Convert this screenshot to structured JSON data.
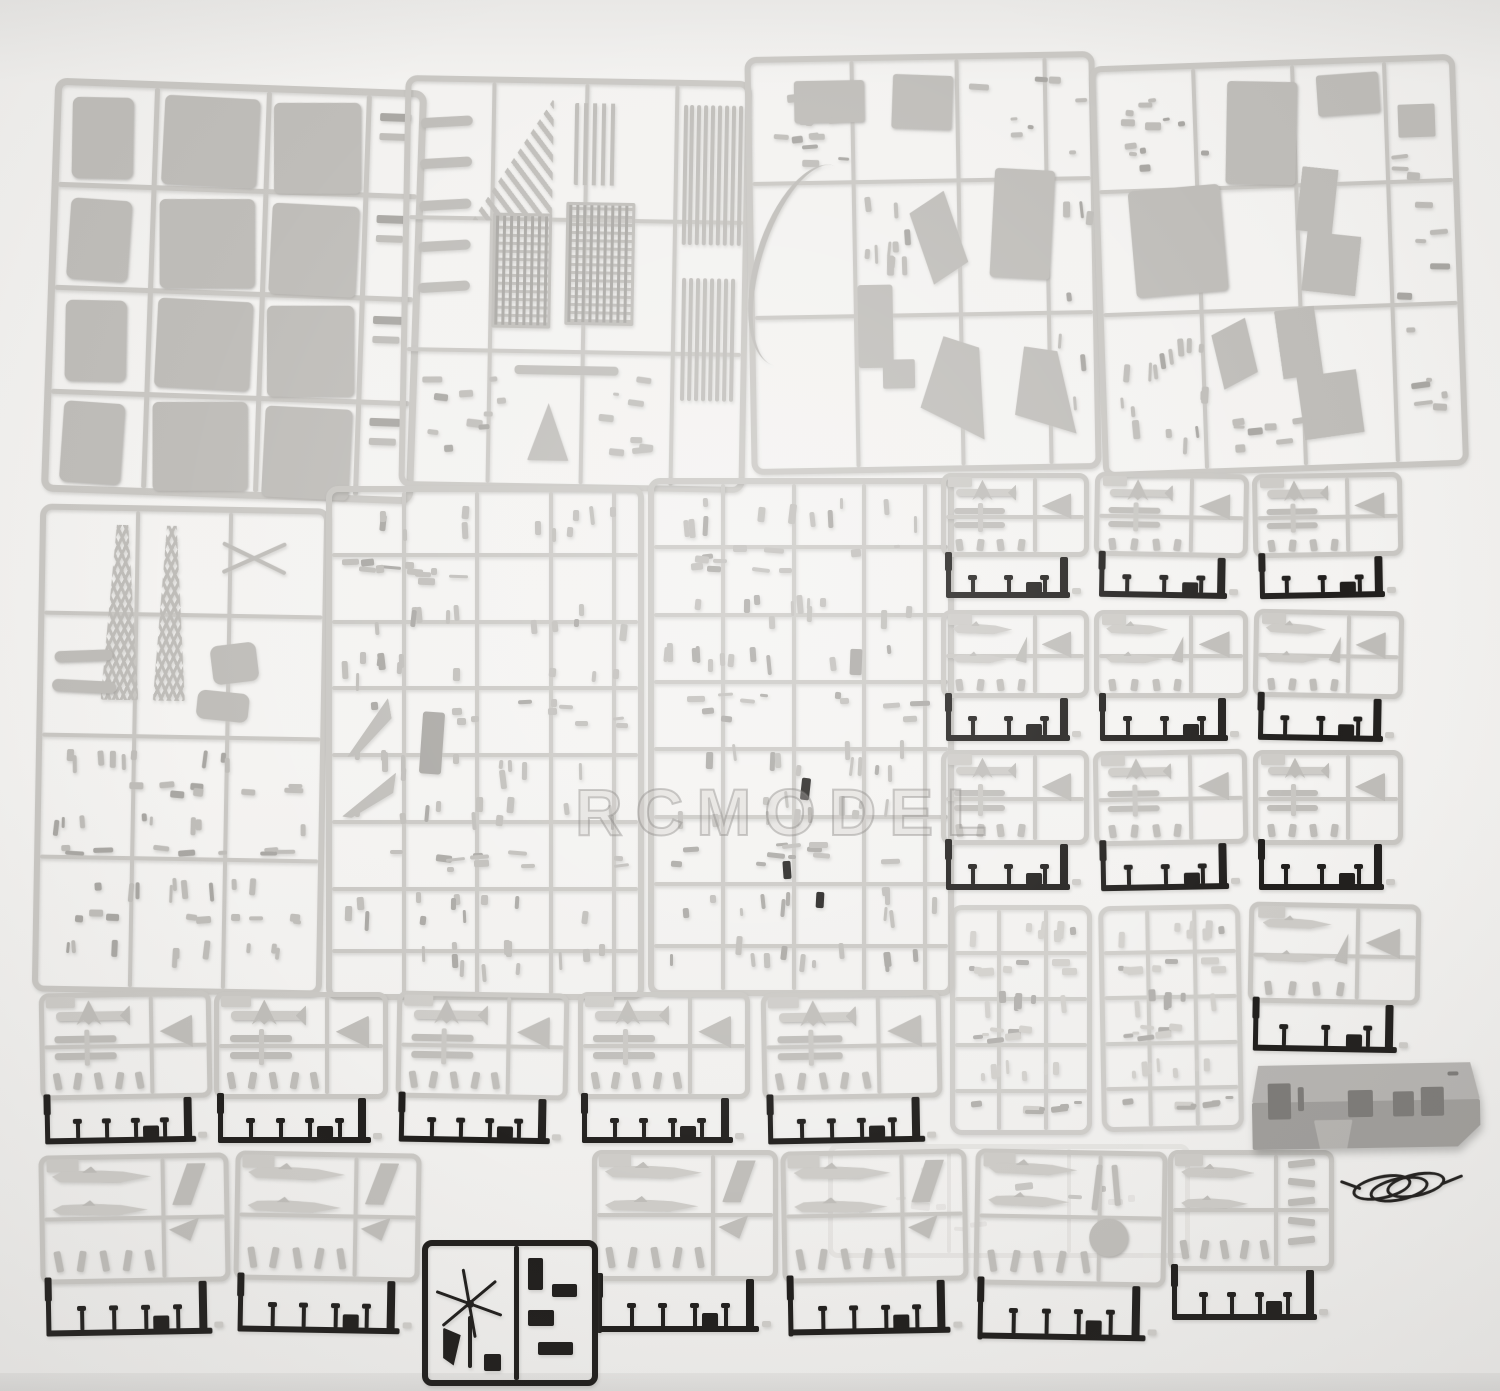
{
  "photo": {
    "width": 1500,
    "height": 1391,
    "background": "#f3f2f0",
    "subject": "plastic-model-kit-sprues-on-white-table"
  },
  "watermark": {
    "text": "RCMODEL"
  },
  "colors": {
    "runner": "#c9c7c3",
    "runnerDark": "#b3b1ae",
    "part": "#bfbdb9",
    "partLight": "#cdcbc7",
    "partDark": "#a9a7a3",
    "black": "#211f1d",
    "ghost": "#dcdad7",
    "boxTop": "#b6b4b1",
    "boxFront": "#a09e9b",
    "boxHole": "#7d7b78",
    "shadow": "rgba(110,108,105,0.28)"
  },
  "sprues": [
    {
      "name": "deck-panel-sprue",
      "kind": "panels",
      "x": 48,
      "y": 84,
      "w": 372,
      "h": 414,
      "rot": 2
    },
    {
      "name": "grating-sprue",
      "kind": "gratings",
      "x": 402,
      "y": 78,
      "w": 346,
      "h": 412,
      "rot": 1
    },
    {
      "name": "island-parts-sprue",
      "kind": "island",
      "x": 748,
      "y": 54,
      "w": 350,
      "h": 418,
      "rot": -1
    },
    {
      "name": "superstructure-block-sprue",
      "kind": "blocks",
      "x": 1096,
      "y": 60,
      "w": 366,
      "h": 412,
      "rot": -2
    },
    {
      "name": "fittings-sprue",
      "kind": "tinytall",
      "x": 36,
      "y": 506,
      "w": 290,
      "h": 488,
      "rot": 1
    },
    {
      "name": "detail-sprue-left",
      "kind": "dense",
      "x": 326,
      "y": 486,
      "w": 318,
      "h": 514,
      "rot": 0,
      "variant": 1
    },
    {
      "name": "detail-sprue-right",
      "kind": "dense",
      "x": 648,
      "y": 478,
      "w": 306,
      "h": 518,
      "rot": 0,
      "variant": 2
    },
    {
      "name": "aircraft-sprue-grid-1",
      "kind": "aircraft-cell",
      "x": 941,
      "y": 473,
      "w": 148,
      "h": 132,
      "rot": 0,
      "variant": 1
    },
    {
      "name": "aircraft-sprue-grid-2",
      "kind": "aircraft-cell",
      "x": 1094,
      "y": 473,
      "w": 154,
      "h": 132,
      "rot": 1,
      "variant": 1
    },
    {
      "name": "aircraft-sprue-grid-3",
      "kind": "aircraft-cell",
      "x": 1253,
      "y": 473,
      "w": 150,
      "h": 132,
      "rot": -1,
      "variant": 1
    },
    {
      "name": "aircraft-sprue-grid-4",
      "kind": "aircraft-cell",
      "x": 941,
      "y": 610,
      "w": 148,
      "h": 138,
      "rot": 0,
      "variant": 2
    },
    {
      "name": "aircraft-sprue-grid-5",
      "kind": "aircraft-cell",
      "x": 1094,
      "y": 610,
      "w": 154,
      "h": 138,
      "rot": 0,
      "variant": 2
    },
    {
      "name": "aircraft-sprue-grid-6",
      "kind": "aircraft-cell",
      "x": 1253,
      "y": 610,
      "w": 150,
      "h": 138,
      "rot": 1,
      "variant": 2
    },
    {
      "name": "aircraft-sprue-grid-7",
      "kind": "aircraft-cell",
      "x": 941,
      "y": 750,
      "w": 148,
      "h": 148,
      "rot": 0,
      "variant": 1
    },
    {
      "name": "aircraft-sprue-grid-8",
      "kind": "aircraft-cell",
      "x": 1094,
      "y": 750,
      "w": 154,
      "h": 148,
      "rot": -1,
      "variant": 1
    },
    {
      "name": "aircraft-sprue-grid-9",
      "kind": "aircraft-cell",
      "x": 1253,
      "y": 750,
      "w": 150,
      "h": 148,
      "rot": 0,
      "variant": 1
    },
    {
      "name": "weapons-sprue-1",
      "kind": "faintdense",
      "x": 950,
      "y": 905,
      "w": 142,
      "h": 230,
      "rot": 0
    },
    {
      "name": "weapons-sprue-2",
      "kind": "faintdense",
      "x": 1100,
      "y": 905,
      "w": 142,
      "h": 226,
      "rot": -1
    },
    {
      "name": "aircraft-sprue-right-column",
      "kind": "aircraft-cell",
      "x": 1248,
      "y": 903,
      "w": 172,
      "h": 158,
      "rot": 1,
      "variant": 2
    },
    {
      "name": "aircraft-sprue-row1-1",
      "kind": "aircraft-row",
      "x": 40,
      "y": 992,
      "w": 172,
      "h": 158,
      "rot": -1,
      "variant": 1
    },
    {
      "name": "aircraft-sprue-row1-2",
      "kind": "aircraft-row",
      "x": 214,
      "y": 992,
      "w": 174,
      "h": 158,
      "rot": 0,
      "variant": 1
    },
    {
      "name": "aircraft-sprue-row1-3",
      "kind": "aircraft-row",
      "x": 396,
      "y": 992,
      "w": 172,
      "h": 158,
      "rot": 1,
      "variant": 1
    },
    {
      "name": "aircraft-sprue-row1-4",
      "kind": "aircraft-row",
      "x": 578,
      "y": 992,
      "w": 172,
      "h": 158,
      "rot": 0,
      "variant": 1
    },
    {
      "name": "aircraft-sprue-row1-5",
      "kind": "aircraft-row",
      "x": 762,
      "y": 992,
      "w": 180,
      "h": 158,
      "rot": -1,
      "variant": 1
    },
    {
      "name": "clear-parts-ghost-sprue",
      "kind": "ghost",
      "x": 828,
      "y": 1144,
      "w": 362,
      "h": 114,
      "rot": 0
    },
    {
      "name": "aircraft-sprue-row2-1",
      "kind": "aircraft-row",
      "x": 40,
      "y": 1154,
      "w": 190,
      "h": 190,
      "rot": -1,
      "variant": 2
    },
    {
      "name": "aircraft-sprue-row2-2",
      "kind": "aircraft-row",
      "x": 234,
      "y": 1152,
      "w": 186,
      "h": 190,
      "rot": 1,
      "variant": 2
    },
    {
      "name": "aircraft-sprue-row2-3",
      "kind": "aircraft-row",
      "x": 592,
      "y": 1150,
      "w": 186,
      "h": 192,
      "rot": 0,
      "variant": 2
    },
    {
      "name": "aircraft-sprue-row2-4",
      "kind": "aircraft-row",
      "x": 782,
      "y": 1150,
      "w": 186,
      "h": 194,
      "rot": -1,
      "variant": 2
    },
    {
      "name": "aircraft-sprue-row2-5",
      "kind": "aircraft-row",
      "x": 974,
      "y": 1150,
      "w": 192,
      "h": 200,
      "rot": 1,
      "variant": 3
    },
    {
      "name": "aircraft-sprue-row2-6",
      "kind": "aircraft-row",
      "x": 1168,
      "y": 1150,
      "w": 166,
      "h": 178,
      "rot": 0,
      "variant": 4
    },
    {
      "name": "helicopter-rotor-black-sprue",
      "kind": "heli-black",
      "x": 422,
      "y": 1240,
      "w": 176,
      "h": 146,
      "rot": 0
    },
    {
      "name": "hull-box-part",
      "kind": "hull-box",
      "x": 1252,
      "y": 1064,
      "w": 228,
      "h": 84,
      "rot": -1
    },
    {
      "name": "power-cord",
      "kind": "cord",
      "x": 1352,
      "y": 1172,
      "w": 100,
      "h": 32,
      "rot": -4
    }
  ]
}
